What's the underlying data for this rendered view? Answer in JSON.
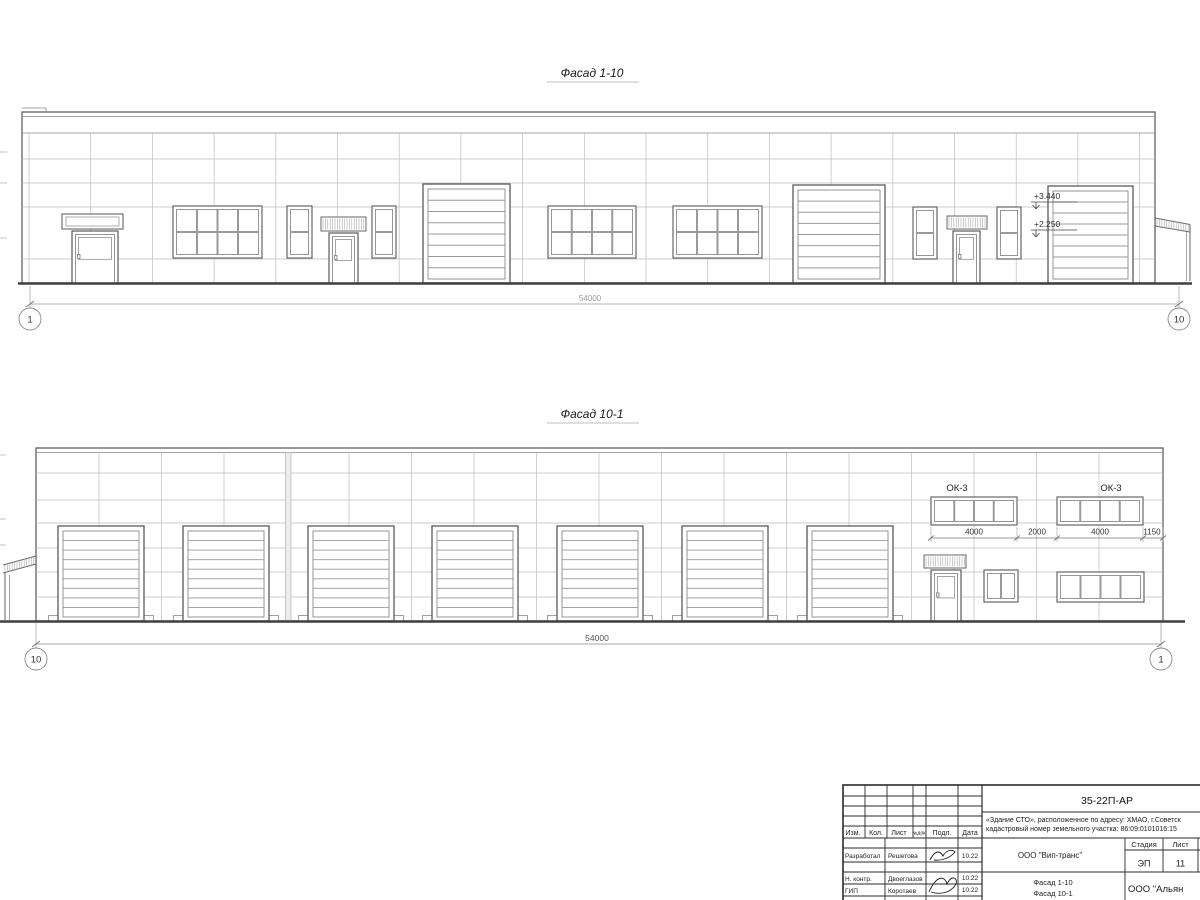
{
  "sheet": {
    "facade_top": {
      "title": "Фасад 1-10",
      "total_dim": "54000",
      "axis_left": "1",
      "axis_right": "10",
      "elev_mark_1": "+3.440",
      "elev_mark_2": "+2.250"
    },
    "facade_bottom": {
      "title": "Фасад 10-1",
      "total_dim": "54000",
      "axis_left": "10",
      "axis_right": "1",
      "window_mark_1": "ОК-3",
      "window_mark_2": "ОК-3",
      "dim_1": "4000",
      "dim_2": "2000",
      "dim_3": "4000",
      "dim_4": "1150"
    },
    "title_block": {
      "doc_number": "35-22П-АР",
      "project_desc_line1": "«Здание СТО», расположенное по адресу: ХМАО, г.Советск",
      "project_desc_line2": "кадастровый номер земельного участка: 86:09:0101016:15",
      "col_izm": "Изм.",
      "col_kol": "Кол.",
      "col_list": "Лист",
      "col_ndoc": "№док.",
      "col_sign": "Подл.",
      "col_date": "Дата",
      "row1_role": "Разработал",
      "row1_name": "Решетова",
      "row1_date": "10.22",
      "row2_role": "Н. контр.",
      "row2_name": "Двоеглазов",
      "row2_date": "10.22",
      "row3_role": "ГИП",
      "row3_name": "Коротаев",
      "row3_date": "10.22",
      "customer": "ООО \"Вип-транс\"",
      "drawing_name_line1": "Фасад 1-10",
      "drawing_name_line2": "Фасад 10-1",
      "stage_label": "Стадия",
      "sheet_label": "Лист",
      "sheets_label": "Л",
      "stage_value": "ЭП",
      "sheet_value": "11",
      "org": "ООО \"Альян"
    }
  }
}
